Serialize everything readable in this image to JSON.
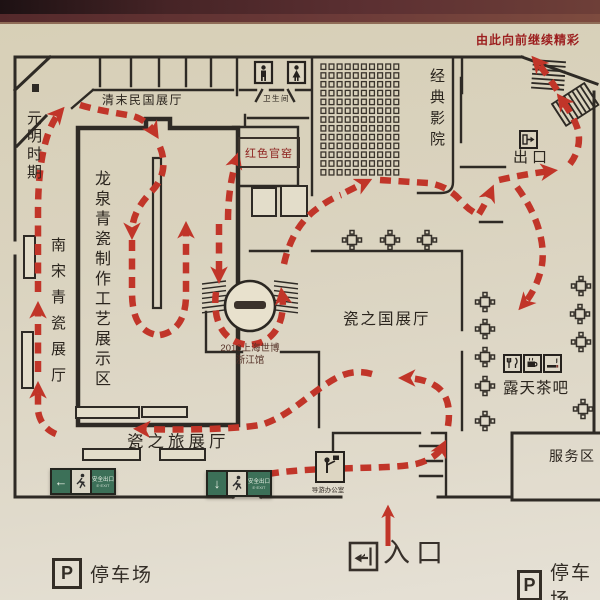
{
  "banner": {
    "text": "由此向前继续精彩"
  },
  "rooms": {
    "qing_republic": "清末民国展厅",
    "yuan_ming": "元明时期",
    "longquan_workshop": "龙泉青瓷制作工艺展示区",
    "southern_song": "南宋青瓷展厅",
    "red_kiln": "红色官窑",
    "cinema": "经典影院",
    "exit": "出口",
    "porcelain_country": "瓷之国展厅",
    "tea_bar": "露天茶吧",
    "porcelain_journey": "瓷之旅展厅",
    "service_area": "服务区",
    "restroom": "卫生间",
    "guide_office": "导游办公室",
    "entrance": "入口"
  },
  "expo": {
    "line1": "2010上海世博",
    "line2": "浙江馆"
  },
  "parking": {
    "symbol": "P",
    "left_label": "停车场",
    "right_label": "停车场"
  },
  "exit_signs": {
    "label": "安全出口",
    "sub": "E·EXIT",
    "left_arrow": "←",
    "down_arrow": "↓"
  },
  "colors": {
    "route_red": "#c13529",
    "wall": "#2e2a25",
    "sign_green": "#3c7058",
    "banner_red": "#9c1f1f",
    "background": "#dad2bd",
    "photo_band": "#5c3032"
  }
}
